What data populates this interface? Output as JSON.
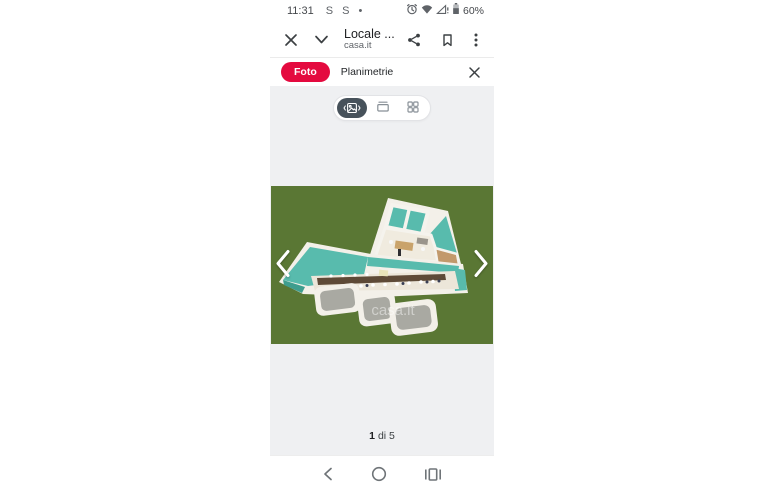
{
  "status_bar": {
    "time": "11:31",
    "notifications": "S S •",
    "battery": "60%"
  },
  "header": {
    "title": "Locale ...",
    "subtitle": "casa.it"
  },
  "tab_bar": {
    "foto": "Foto",
    "planimetrie": "Planimetrie"
  },
  "gallery": {
    "view_modes": [
      "carousel",
      "stack",
      "grid"
    ],
    "selected_view": "carousel",
    "watermark": "casa.it",
    "page_current": "1",
    "page_of": "di 5"
  },
  "colors": {
    "brand_red": "#E40A3F",
    "gallery_background": "#EFF0F2",
    "toggle_selected_pill": "#47525B",
    "plan_background_green": "#5A7734",
    "plan_wall_teal": "#58BBAD",
    "plan_wall_white": "#F3F0E9",
    "icon_gray": "#5F6368"
  }
}
